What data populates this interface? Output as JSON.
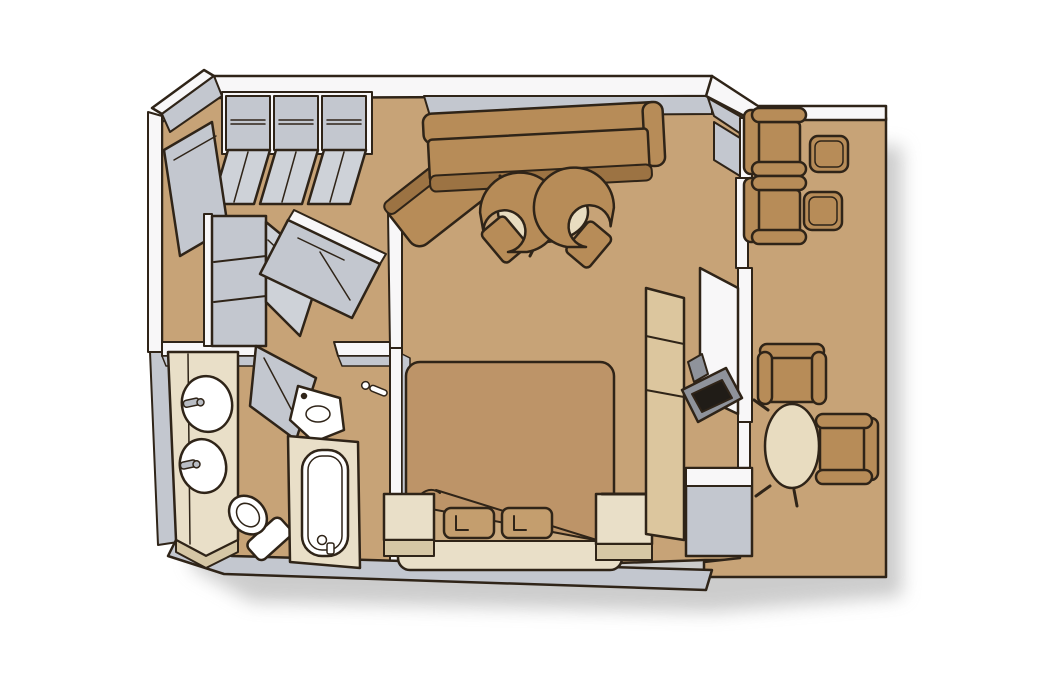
{
  "scene": {
    "type": "floor-plan",
    "subject": "suite-cabin-with-balcony"
  },
  "palette": {
    "background": "#ffffff",
    "floor": "#c7a377",
    "wall_white": "#f8f7f8",
    "wall_gray": "#c3c7cf",
    "wall_gray_light": "#ced2d8",
    "outline": "#2f2418",
    "furniture_brown": "#b78c58",
    "furniture_brown_dark": "#9c7343",
    "bed_cover": "#bd9468",
    "sheet": "#cbab80",
    "pillow": "#c49e6e",
    "cream": "#e9dfc8",
    "cream_dark": "#d6c7a5",
    "table_cream": "#e8dcc0",
    "cabinet_tan": "#dcc69e",
    "fixture_white": "#ffffff",
    "hardware_gray": "#b9bdc4",
    "tv_gray": "#8f939b",
    "tv_screen": "#201c17",
    "shadow": "#9a9a9a"
  },
  "rooms": {
    "entry": {
      "items": [
        "closet-1",
        "closet-2",
        "closet-3",
        "entrance-door",
        "shelf-unit",
        "mirrored-wardrobe"
      ]
    },
    "bathroom": {
      "items": [
        "double-sink-vanity",
        "sink-1",
        "sink-2",
        "toilet",
        "bathtub",
        "shower-door",
        "corner-sink",
        "faucet"
      ]
    },
    "living_room": {
      "items": [
        "l-shaped-sofa",
        "chaise",
        "round-coffee-table",
        "tub-chair-left",
        "tub-chair-right"
      ]
    },
    "bedroom": {
      "items": [
        "double-bed",
        "pillow-1",
        "pillow-2",
        "nightstand-left",
        "nightstand-right",
        "tv-cabinet",
        "tv"
      ]
    },
    "balcony": {
      "items": [
        "lounge-chair-1",
        "lounge-chair-2",
        "side-table-1",
        "side-table-2",
        "oval-table",
        "balcony-chair-top",
        "balcony-chair-right"
      ]
    }
  }
}
